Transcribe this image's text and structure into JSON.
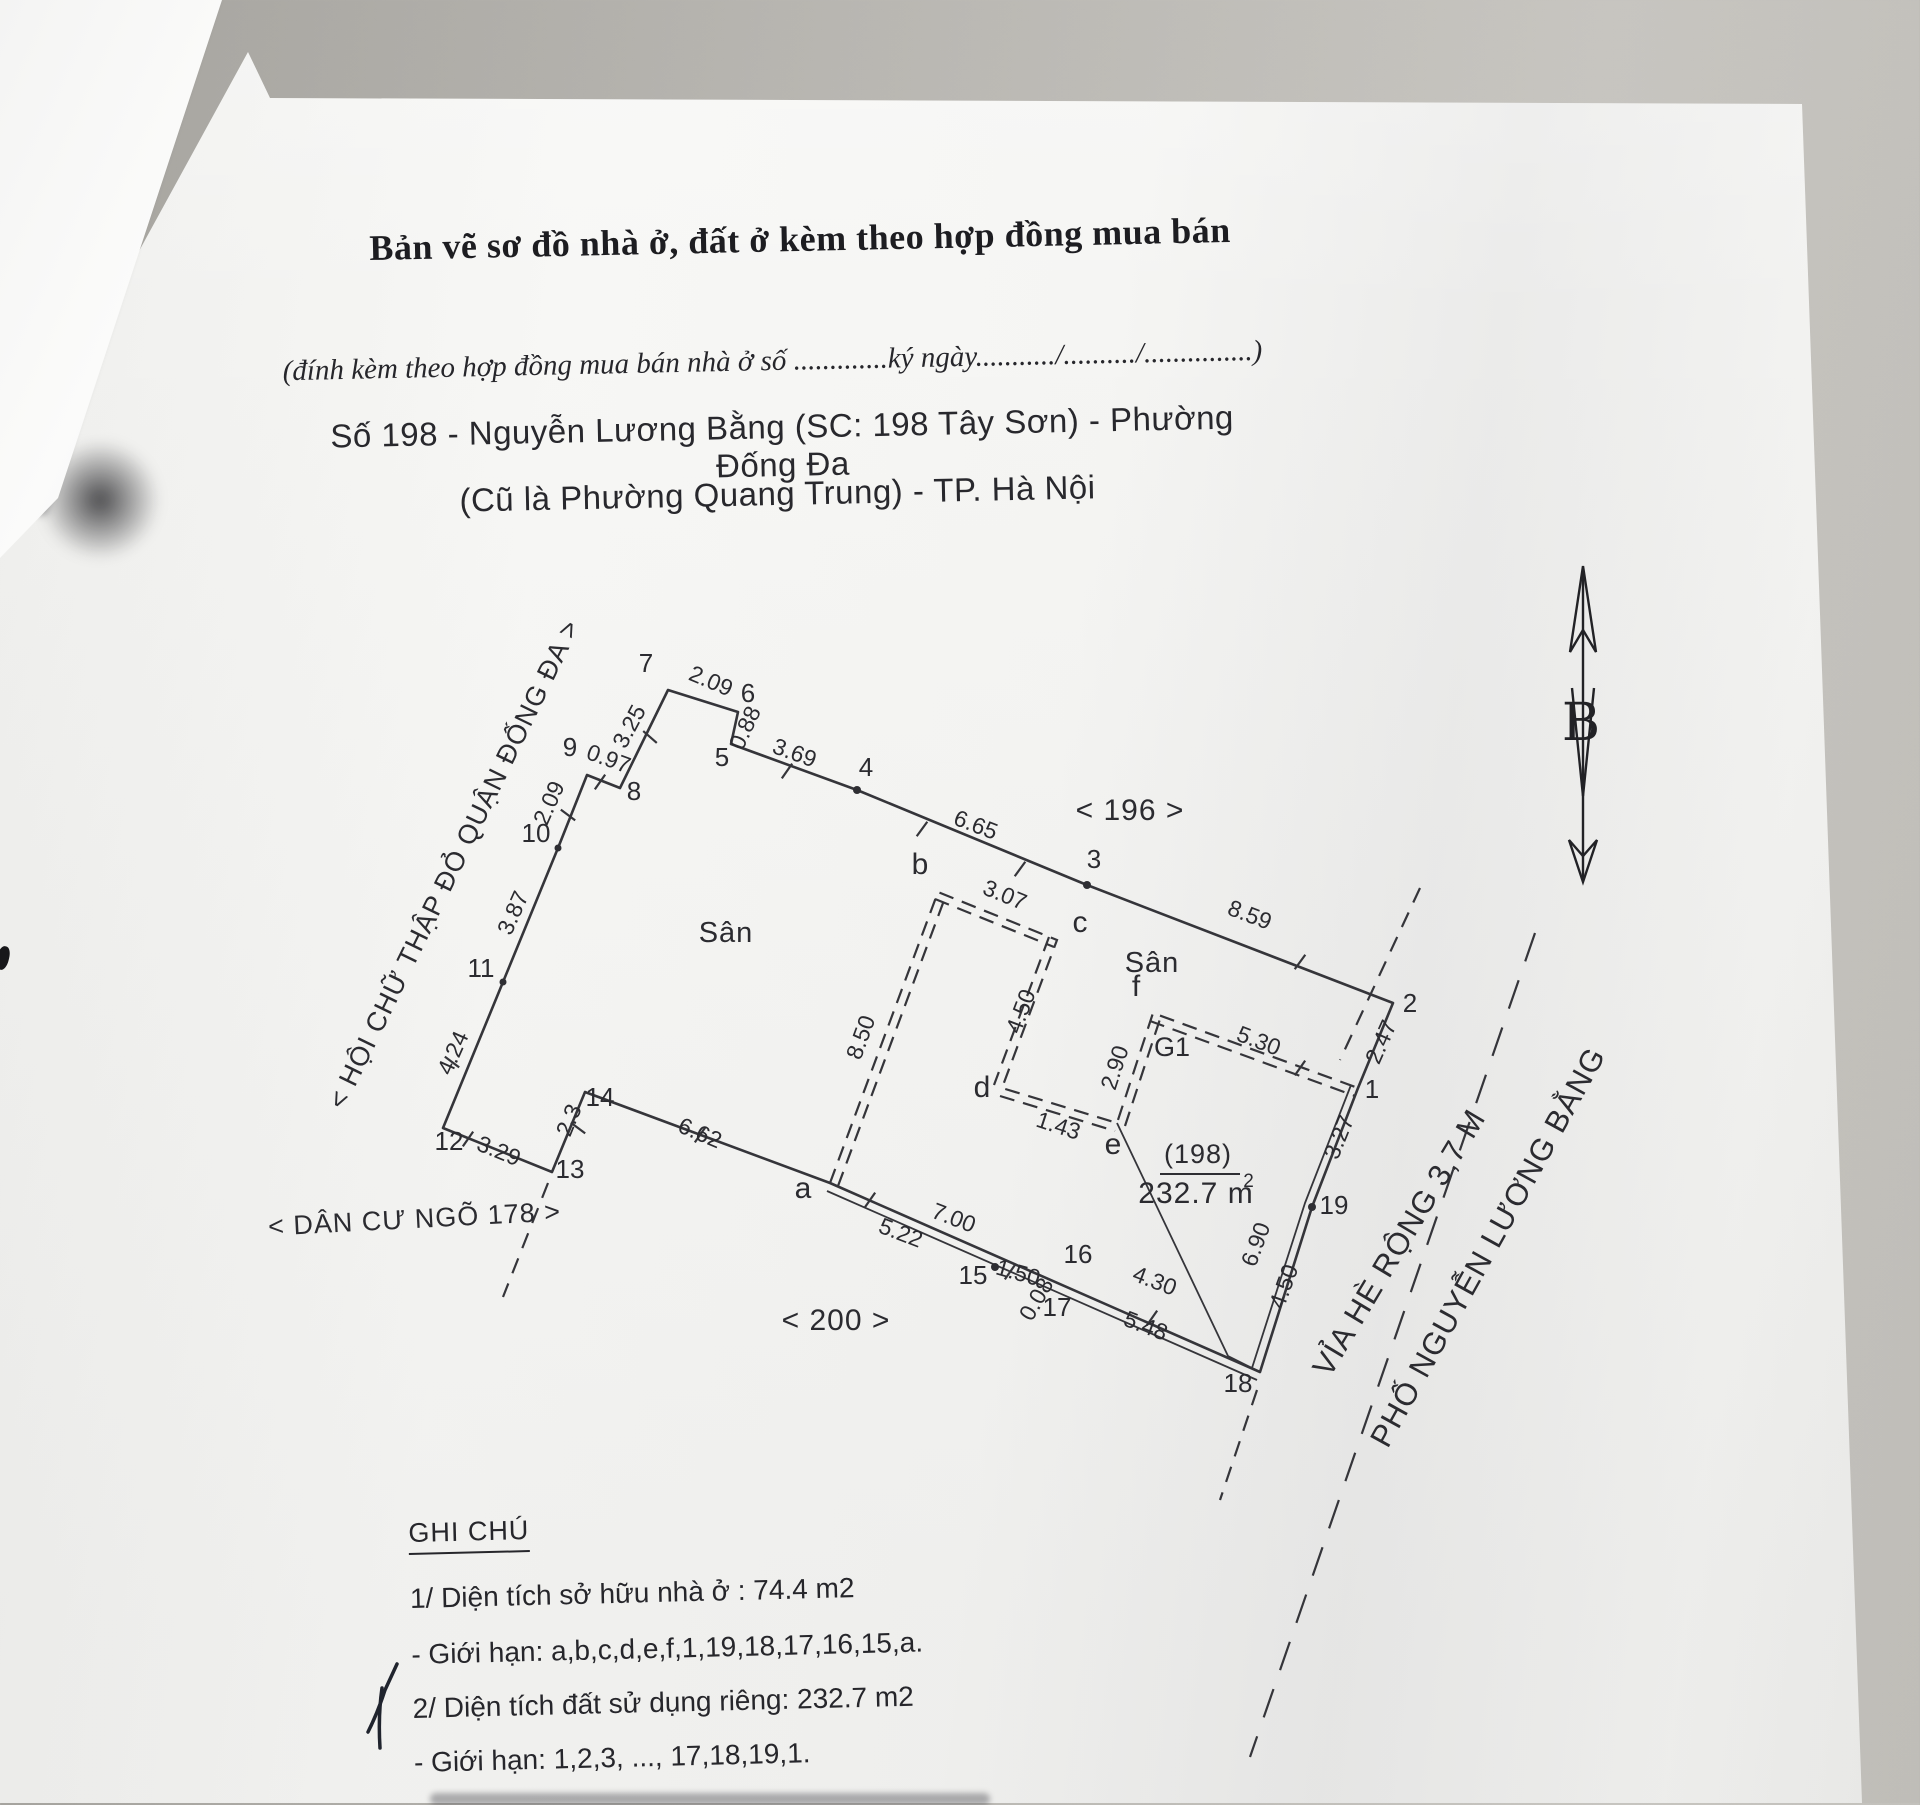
{
  "header": {
    "title": "Bản vẽ sơ đồ nhà ở, đất ở kèm theo hợp đồng mua bán",
    "subtitle": "(đính kèm theo hợp đồng mua bán nhà ở số .............ký ngày.........../........../...............)",
    "address_line1": "Số 198 - Nguyễn Lương Bằng (SC: 198 Tây Sơn) - Phường Đống Đa",
    "address_line2": "(Cũ là Phường Quang Trung) - TP. Hà Nội"
  },
  "compass": {
    "label": "B"
  },
  "plan": {
    "parcel_number": "(198)",
    "parcel_area_m2": "232.7",
    "dimensions": [
      {
        "text": "2.09",
        "x": 708,
        "y": 688,
        "rot": 23
      },
      {
        "text": "0.88",
        "x": 752,
        "y": 731,
        "rot": -65
      },
      {
        "text": "3.25",
        "x": 636,
        "y": 730,
        "rot": -62
      },
      {
        "text": "0.97",
        "x": 606,
        "y": 766,
        "rot": 20
      },
      {
        "text": "2.09",
        "x": 556,
        "y": 806,
        "rot": -66
      },
      {
        "text": "3.87",
        "x": 520,
        "y": 916,
        "rot": -66
      },
      {
        "text": "4.24",
        "x": 460,
        "y": 1056,
        "rot": -66
      },
      {
        "text": "3.29",
        "x": 496,
        "y": 1158,
        "rot": 22
      },
      {
        "text": "2.3",
        "x": 576,
        "y": 1123,
        "rot": -68
      },
      {
        "text": "6.62",
        "x": 697,
        "y": 1140,
        "rot": 23
      },
      {
        "text": "3.69",
        "x": 792,
        "y": 760,
        "rot": 20
      },
      {
        "text": "6.65",
        "x": 973,
        "y": 832,
        "rot": 21
      },
      {
        "text": "8.59",
        "x": 1247,
        "y": 922,
        "rot": 21
      },
      {
        "text": "2.47",
        "x": 1388,
        "y": 1045,
        "rot": -66
      },
      {
        "text": "3.27",
        "x": 1346,
        "y": 1140,
        "rot": -68
      },
      {
        "text": "6.90",
        "x": 1263,
        "y": 1247,
        "rot": -70
      },
      {
        "text": "4.50",
        "x": 1291,
        "y": 1289,
        "rot": -70
      },
      {
        "text": "5.22",
        "x": 898,
        "y": 1240,
        "rot": 21
      },
      {
        "text": "7.00",
        "x": 951,
        "y": 1225,
        "rot": 21
      },
      {
        "text": "1.50",
        "x": 1016,
        "y": 1280,
        "rot": 16
      },
      {
        "text": "0.08",
        "x": 1043,
        "y": 1303,
        "rot": -60
      },
      {
        "text": "4.30",
        "x": 1152,
        "y": 1288,
        "rot": 21
      },
      {
        "text": "5.48",
        "x": 1143,
        "y": 1333,
        "rot": 21
      },
      {
        "text": "8.50",
        "x": 868,
        "y": 1040,
        "rot": -70
      },
      {
        "text": "3.07",
        "x": 1002,
        "y": 902,
        "rot": 22
      },
      {
        "text": "4.50",
        "x": 1028,
        "y": 1014,
        "rot": -69
      },
      {
        "text": "1.43",
        "x": 1056,
        "y": 1133,
        "rot": 18
      },
      {
        "text": "2.90",
        "x": 1122,
        "y": 1070,
        "rot": -72
      },
      {
        "text": "5.30",
        "x": 1256,
        "y": 1048,
        "rot": 21
      }
    ],
    "vertices": [
      {
        "text": "1",
        "x": 1372,
        "y": 1098
      },
      {
        "text": "2",
        "x": 1410,
        "y": 1012
      },
      {
        "text": "3",
        "x": 1094,
        "y": 868
      },
      {
        "text": "4",
        "x": 866,
        "y": 776
      },
      {
        "text": "5",
        "x": 722,
        "y": 766
      },
      {
        "text": "6",
        "x": 748,
        "y": 702
      },
      {
        "text": "7",
        "x": 646,
        "y": 672
      },
      {
        "text": "8",
        "x": 634,
        "y": 800
      },
      {
        "text": "9",
        "x": 570,
        "y": 756
      },
      {
        "text": "10",
        "x": 536,
        "y": 842
      },
      {
        "text": "11",
        "x": 481,
        "y": 977
      },
      {
        "text": "12",
        "x": 449,
        "y": 1150
      },
      {
        "text": "13",
        "x": 570,
        "y": 1178
      },
      {
        "text": "14",
        "x": 600,
        "y": 1106
      },
      {
        "text": "15",
        "x": 973,
        "y": 1284
      },
      {
        "text": "16",
        "x": 1078,
        "y": 1263
      },
      {
        "text": "17",
        "x": 1057,
        "y": 1316
      },
      {
        "text": "18",
        "x": 1238,
        "y": 1392
      },
      {
        "text": "19",
        "x": 1334,
        "y": 1214
      },
      {
        "text": "a",
        "x": 803,
        "y": 1198,
        "fs": 30
      },
      {
        "text": "b",
        "x": 920,
        "y": 874,
        "fs": 30
      },
      {
        "text": "c",
        "x": 1080,
        "y": 932,
        "fs": 30
      },
      {
        "text": "d",
        "x": 982,
        "y": 1097,
        "fs": 30
      },
      {
        "text": "e",
        "x": 1113,
        "y": 1154,
        "fs": 30
      },
      {
        "text": "f",
        "x": 1136,
        "y": 996,
        "fs": 30
      },
      {
        "text": "G1",
        "x": 1172,
        "y": 1056,
        "fs": 27
      }
    ],
    "labels": [
      {
        "text": "Sân",
        "x": 726,
        "y": 942,
        "fs": 29
      },
      {
        "text": "Sân",
        "x": 1152,
        "y": 972,
        "fs": 29
      },
      {
        "text": "< 196 >",
        "x": 1130,
        "y": 820,
        "fs": 30
      },
      {
        "text": "< 200 >",
        "x": 836,
        "y": 1330,
        "fs": 30
      },
      {
        "text": "< DÂN CƯ NGÕ 178 >",
        "x": 415,
        "y": 1228,
        "fs": 27,
        "rot": -3
      },
      {
        "text": "< HỘI CHỮ THẬP ĐỎ QUẬN ĐỐNG ĐA >",
        "x": 462,
        "y": 868,
        "fs": 27,
        "rot": -64
      },
      {
        "text": "VỈA HÈ RỘNG 3,7 M",
        "x": 1408,
        "y": 1248,
        "fs": 31,
        "rot": -59
      },
      {
        "text": "PHỐ NGUYỄN LƯƠNG BẰNG",
        "x": 1497,
        "y": 1252,
        "fs": 31,
        "rot": -61
      },
      {
        "text": "(198)",
        "x": 1198,
        "y": 1163,
        "fs": 27
      },
      {
        "text": "232.7 m",
        "x": 1196,
        "y": 1203,
        "fs": 30
      },
      {
        "text": "2",
        "x": 1249,
        "y": 1187,
        "fs": 19
      }
    ]
  },
  "notes": {
    "heading": "GHI CHÚ",
    "items": [
      "1/ Diện tích sở hữu nhà ở : 74.4 m2",
      "- Giới hạn: a,b,c,d,e,f,1,19,18,17,16,15,a.",
      "2/ Diện tích đất sử dụng riêng: 232.7 m2",
      "- Giới hạn: 1,2,3, ..., 17,18,19,1."
    ]
  }
}
